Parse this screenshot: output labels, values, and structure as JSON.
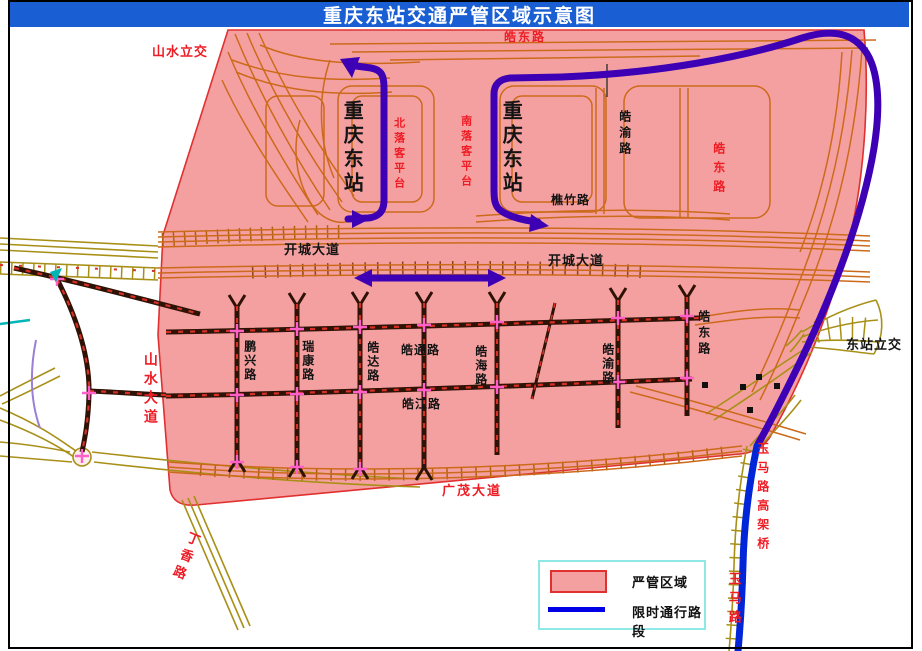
{
  "title": "重庆东站交通严管区域示意图",
  "legend": {
    "zone": "严管区域",
    "route": "限时通行路段"
  },
  "colors": {
    "title_bar": "#1A5ED4",
    "zone_fill": "#F5A0A0",
    "zone_border": "#E03030",
    "restricted_route_purple": "#3D00B5",
    "restricted_route_blue": "#0026D8",
    "road_orange": "#CC6A1B",
    "road_khaki": "#A89018",
    "road_dark": "#2E1206",
    "road_red_dash": "#D93025",
    "junction_marker": "#FF5FC8",
    "legend_border": "#8EE8E6",
    "label_red": "#EE1C25",
    "label_black": "#141414"
  },
  "map": {
    "labels": [
      {
        "name": "shanshui-lijiao",
        "text": "山水立交",
        "x": 152,
        "y": 45,
        "color": "red",
        "dir": "h",
        "size": 13,
        "bold": true,
        "spacing": 1
      },
      {
        "name": "haodong-lu-top",
        "text": "皓东路",
        "x": 504,
        "y": 31,
        "color": "red",
        "dir": "h",
        "size": 12,
        "bold": true,
        "spacing": 2
      },
      {
        "name": "haodong-lu-right-red",
        "text": "皓东路",
        "x": 712,
        "y": 142,
        "color": "red",
        "dir": "v",
        "size": 12,
        "bold": true,
        "spacing": 7
      },
      {
        "name": "bei-luoke-pingtai",
        "text": "北落客平台",
        "x": 392,
        "y": 117,
        "color": "red",
        "dir": "v",
        "size": 11,
        "bold": true,
        "spacing": 4
      },
      {
        "name": "nan-luoke-pingtai",
        "text": "南落客平台",
        "x": 459,
        "y": 115,
        "color": "red",
        "dir": "v",
        "size": 11,
        "bold": true,
        "spacing": 4
      },
      {
        "name": "station-west",
        "text": "重庆东站",
        "x": 340,
        "y": 100,
        "color": "blk",
        "dir": "v",
        "size": 20,
        "bold": true,
        "spacing": 4
      },
      {
        "name": "station-east",
        "text": "重庆东站",
        "x": 499,
        "y": 100,
        "color": "blk",
        "dir": "v",
        "size": 20,
        "bold": true,
        "spacing": 4
      },
      {
        "name": "haoyu-lu-upper",
        "text": "皓渝路",
        "x": 618,
        "y": 110,
        "color": "blk",
        "dir": "v",
        "size": 12,
        "bold": true,
        "spacing": 4
      },
      {
        "name": "qiaozhu-lu",
        "text": "樵竹路",
        "x": 551,
        "y": 194,
        "color": "blk",
        "dir": "h",
        "size": 12,
        "bold": true,
        "spacing": 1
      },
      {
        "name": "kaicheng-dadao-west",
        "text": "开城大道",
        "x": 284,
        "y": 243,
        "color": "blk",
        "dir": "h",
        "size": 13,
        "bold": true,
        "spacing": 1
      },
      {
        "name": "kaicheng-dadao-east",
        "text": "开城大道",
        "x": 548,
        "y": 254,
        "color": "blk",
        "dir": "h",
        "size": 13,
        "bold": true,
        "spacing": 1
      },
      {
        "name": "shanshui-dadao",
        "text": "山水大道",
        "x": 143,
        "y": 352,
        "color": "red",
        "dir": "v",
        "size": 14,
        "bold": true,
        "spacing": 5
      },
      {
        "name": "pengxing-lu",
        "text": "鹏兴路",
        "x": 243,
        "y": 340,
        "color": "blk",
        "dir": "v",
        "size": 12,
        "bold": true,
        "spacing": 2
      },
      {
        "name": "ruikang-lu",
        "text": "瑞康路",
        "x": 301,
        "y": 340,
        "color": "blk",
        "dir": "v",
        "size": 12,
        "bold": true,
        "spacing": 2
      },
      {
        "name": "haoda-lu",
        "text": "皓达路",
        "x": 366,
        "y": 341,
        "color": "blk",
        "dir": "v",
        "size": 12,
        "bold": true,
        "spacing": 2
      },
      {
        "name": "haotong-lu",
        "text": "皓通路",
        "x": 401,
        "y": 344,
        "color": "blk",
        "dir": "h",
        "size": 12,
        "bold": true,
        "spacing": 1
      },
      {
        "name": "haohai-lu",
        "text": "皓海路",
        "x": 474,
        "y": 345,
        "color": "blk",
        "dir": "v",
        "size": 12,
        "bold": true,
        "spacing": 2
      },
      {
        "name": "haojiang-lu",
        "text": "皓江路",
        "x": 402,
        "y": 398,
        "color": "blk",
        "dir": "h",
        "size": 12,
        "bold": true,
        "spacing": 1
      },
      {
        "name": "haoyu-lu-lower",
        "text": "皓渝路",
        "x": 601,
        "y": 343,
        "color": "blk",
        "dir": "v",
        "size": 12,
        "bold": true,
        "spacing": 2
      },
      {
        "name": "haodong-lu-lower",
        "text": "皓东路",
        "x": 697,
        "y": 310,
        "color": "blk",
        "dir": "v",
        "size": 12,
        "bold": true,
        "spacing": 4
      },
      {
        "name": "dongzhan-lijiao",
        "text": "东站立交",
        "x": 846,
        "y": 338,
        "color": "blk",
        "dir": "h",
        "size": 13,
        "bold": true,
        "spacing": 1
      },
      {
        "name": "yuma-lu-gaojiaqiao",
        "text": "玉马路高架桥",
        "x": 756,
        "y": 442,
        "color": "red",
        "dir": "v",
        "size": 12,
        "bold": true,
        "spacing": 7
      },
      {
        "name": "yuma-lu",
        "text": "玉马路",
        "x": 727,
        "y": 572,
        "color": "red",
        "dir": "v",
        "size": 13,
        "bold": true,
        "spacing": 6
      },
      {
        "name": "dingxiang-lu",
        "text": "丁香路",
        "x": 188,
        "y": 532,
        "color": "red",
        "dir": "v",
        "size": 13,
        "bold": true,
        "spacing": 5,
        "rot": 22
      },
      {
        "name": "guangmao-dadao",
        "text": "广茂大道",
        "x": 442,
        "y": 484,
        "color": "red",
        "dir": "h",
        "size": 13,
        "bold": true,
        "spacing": 2
      }
    ]
  }
}
